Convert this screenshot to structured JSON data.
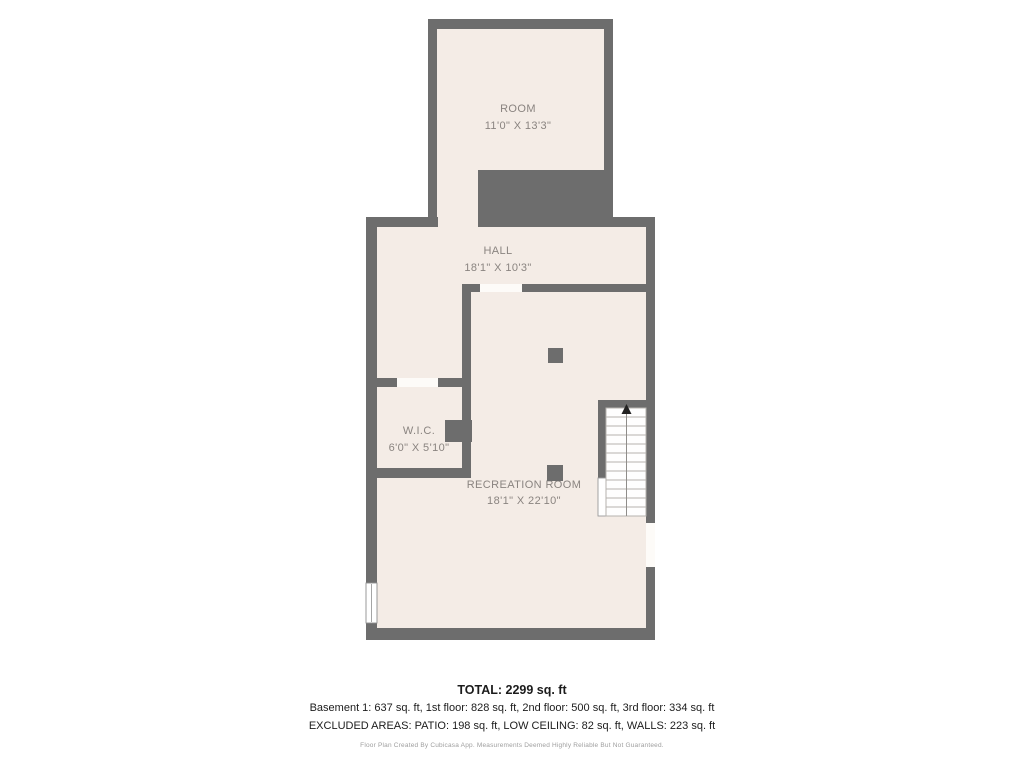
{
  "plan": {
    "wall_color": "#6d6d6d",
    "floor_color": "#f4ece6",
    "label_color": "#8a8480",
    "rooms": [
      {
        "name": "ROOM",
        "dims": "11'0\" X 13'3\""
      },
      {
        "name": "HALL",
        "dims": "18'1\" X 10'3\""
      },
      {
        "name": "W.I.C.",
        "dims": "6'0\" X 5'10\""
      },
      {
        "name": "RECREATION ROOM",
        "dims": "18'1\" X 22'10\""
      }
    ],
    "stairs": {
      "icon": "arrow-up"
    }
  },
  "summary": {
    "total": "TOTAL: 2299 sq. ft",
    "floors": "Basement 1: 637 sq. ft, 1st floor: 828 sq. ft, 2nd floor: 500 sq. ft, 3rd floor: 334 sq. ft",
    "excluded": "EXCLUDED AREAS: PATIO: 198 sq. ft, LOW CEILING: 82 sq. ft, WALLS: 223 sq. ft"
  },
  "footer": {
    "disclaimer": "Floor Plan Created By Cubicasa App. Measurements Deemed Highly Reliable But Not Guaranteed."
  }
}
